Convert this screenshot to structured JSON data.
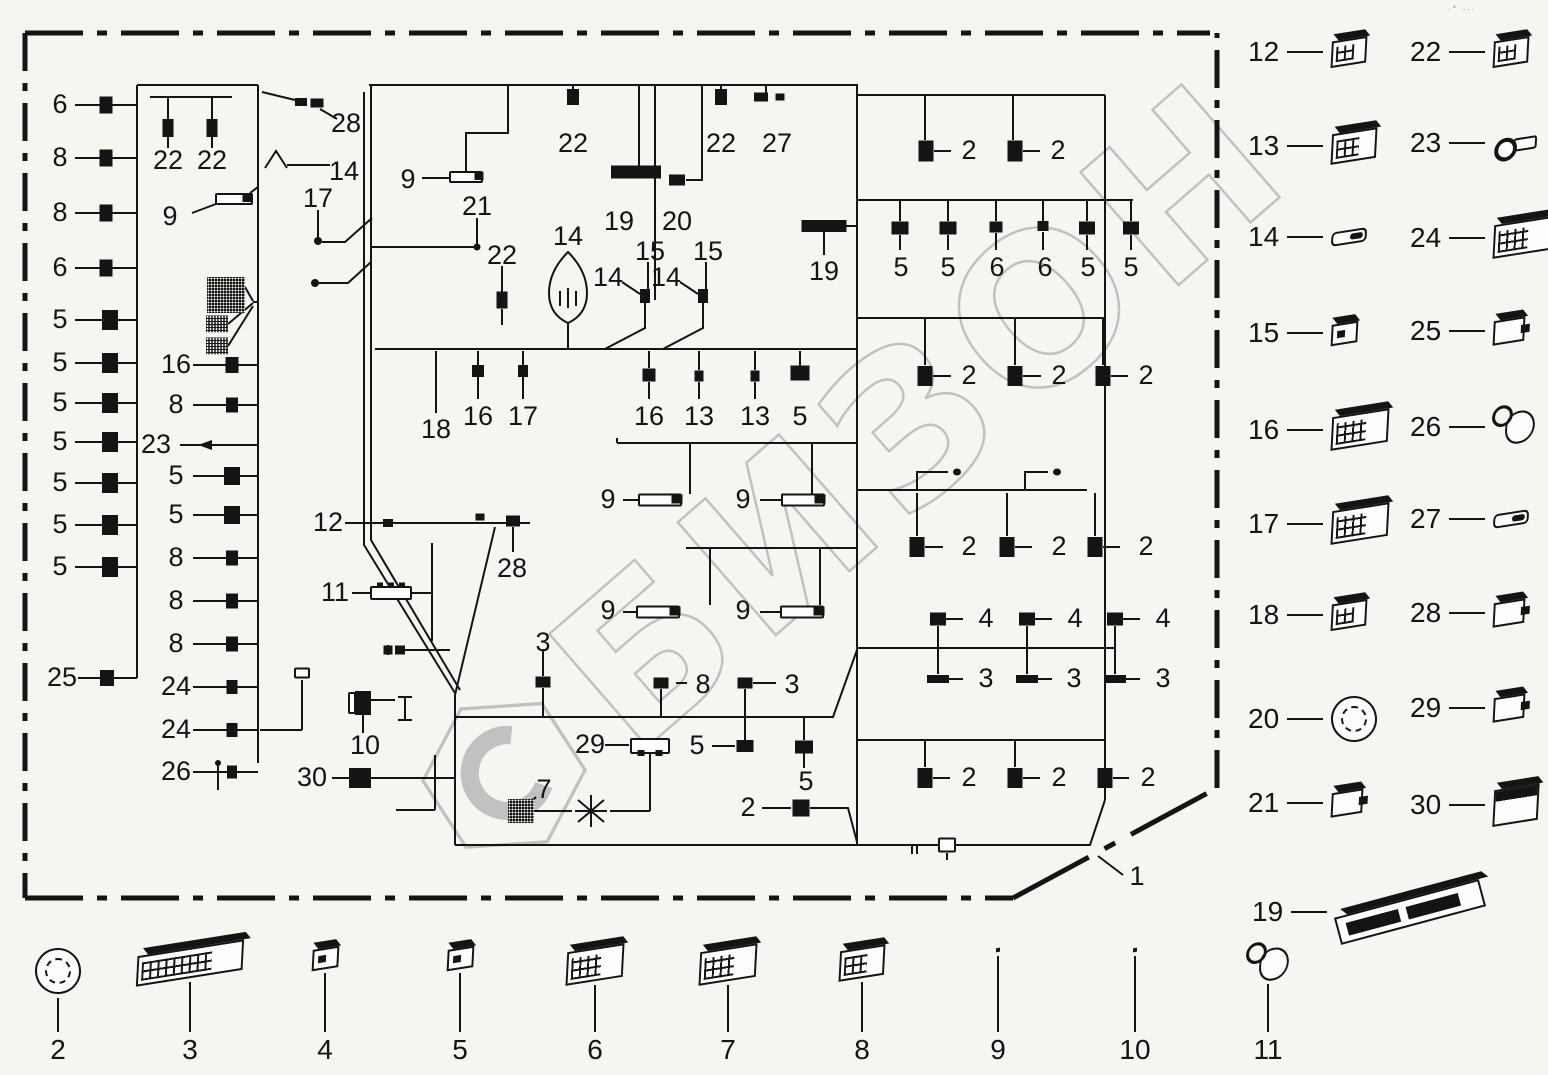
{
  "watermark": {
    "text": "БИЗОН",
    "color": "#c1c1c1"
  },
  "corner_marks": "∙°  ∙∙∙",
  "border": {
    "part_label": "1"
  },
  "diagram": {
    "callouts": [
      {
        "n": "6",
        "x": 60,
        "y": 105
      },
      {
        "n": "8",
        "x": 60,
        "y": 158
      },
      {
        "n": "8",
        "x": 60,
        "y": 213
      },
      {
        "n": "6",
        "x": 60,
        "y": 268
      },
      {
        "n": "5",
        "x": 60,
        "y": 320
      },
      {
        "n": "5",
        "x": 60,
        "y": 363
      },
      {
        "n": "5",
        "x": 60,
        "y": 403
      },
      {
        "n": "5",
        "x": 60,
        "y": 442
      },
      {
        "n": "5",
        "x": 60,
        "y": 483
      },
      {
        "n": "5",
        "x": 60,
        "y": 525
      },
      {
        "n": "5",
        "x": 60,
        "y": 567
      },
      {
        "n": "25",
        "x": 62,
        "y": 678
      },
      {
        "n": "22",
        "x": 168,
        "y": 161
      },
      {
        "n": "22",
        "x": 212,
        "y": 161
      },
      {
        "n": "9",
        "x": 170,
        "y": 217
      },
      {
        "n": "16",
        "x": 176,
        "y": 365
      },
      {
        "n": "8",
        "x": 176,
        "y": 405
      },
      {
        "n": "23",
        "x": 156,
        "y": 445
      },
      {
        "n": "5",
        "x": 176,
        "y": 476
      },
      {
        "n": "5",
        "x": 176,
        "y": 515
      },
      {
        "n": "8",
        "x": 176,
        "y": 558
      },
      {
        "n": "8",
        "x": 176,
        "y": 601
      },
      {
        "n": "8",
        "x": 176,
        "y": 644
      },
      {
        "n": "24",
        "x": 176,
        "y": 687
      },
      {
        "n": "24",
        "x": 176,
        "y": 730
      },
      {
        "n": "26",
        "x": 176,
        "y": 772
      },
      {
        "n": "28",
        "x": 346,
        "y": 124
      },
      {
        "n": "14",
        "x": 344,
        "y": 172
      },
      {
        "n": "17",
        "x": 318,
        "y": 199
      },
      {
        "n": "9",
        "x": 408,
        "y": 180
      },
      {
        "n": "21",
        "x": 477,
        "y": 207
      },
      {
        "n": "22",
        "x": 502,
        "y": 256
      },
      {
        "n": "22",
        "x": 573,
        "y": 144
      },
      {
        "n": "19",
        "x": 619,
        "y": 222
      },
      {
        "n": "20",
        "x": 677,
        "y": 222
      },
      {
        "n": "22",
        "x": 721,
        "y": 144
      },
      {
        "n": "27",
        "x": 777,
        "y": 144
      },
      {
        "n": "14",
        "x": 568,
        "y": 237
      },
      {
        "n": "15",
        "x": 650,
        "y": 252
      },
      {
        "n": "15",
        "x": 708,
        "y": 252
      },
      {
        "n": "14",
        "x": 608,
        "y": 278
      },
      {
        "n": "14",
        "x": 666,
        "y": 278
      },
      {
        "n": "19",
        "x": 824,
        "y": 272
      },
      {
        "n": "18",
        "x": 436,
        "y": 430
      },
      {
        "n": "16",
        "x": 478,
        "y": 417
      },
      {
        "n": "17",
        "x": 523,
        "y": 417
      },
      {
        "n": "16",
        "x": 649,
        "y": 417
      },
      {
        "n": "13",
        "x": 699,
        "y": 417
      },
      {
        "n": "13",
        "x": 755,
        "y": 417
      },
      {
        "n": "5",
        "x": 800,
        "y": 417
      },
      {
        "n": "12",
        "x": 328,
        "y": 523
      },
      {
        "n": "28",
        "x": 512,
        "y": 569
      },
      {
        "n": "11",
        "x": 335,
        "y": 593
      },
      {
        "n": "9",
        "x": 608,
        "y": 500
      },
      {
        "n": "9",
        "x": 743,
        "y": 500
      },
      {
        "n": "9",
        "x": 608,
        "y": 611
      },
      {
        "n": "9",
        "x": 743,
        "y": 611
      },
      {
        "n": "10",
        "x": 365,
        "y": 746
      },
      {
        "n": "30",
        "x": 312,
        "y": 778
      },
      {
        "n": "3",
        "x": 543,
        "y": 643
      },
      {
        "n": "8",
        "x": 703,
        "y": 685
      },
      {
        "n": "3",
        "x": 792,
        "y": 685
      },
      {
        "n": "29",
        "x": 590,
        "y": 745
      },
      {
        "n": "5",
        "x": 697,
        "y": 746
      },
      {
        "n": "5",
        "x": 806,
        "y": 782
      },
      {
        "n": "7",
        "x": 544,
        "y": 790
      },
      {
        "n": "2",
        "x": 748,
        "y": 808
      },
      {
        "n": "2",
        "x": 969,
        "y": 151
      },
      {
        "n": "2",
        "x": 1058,
        "y": 151
      },
      {
        "n": "5",
        "x": 901,
        "y": 268
      },
      {
        "n": "5",
        "x": 948,
        "y": 268
      },
      {
        "n": "6",
        "x": 997,
        "y": 268
      },
      {
        "n": "6",
        "x": 1045,
        "y": 268
      },
      {
        "n": "5",
        "x": 1088,
        "y": 268
      },
      {
        "n": "5",
        "x": 1131,
        "y": 268
      },
      {
        "n": "2",
        "x": 969,
        "y": 376
      },
      {
        "n": "2",
        "x": 1059,
        "y": 376
      },
      {
        "n": "2",
        "x": 1146,
        "y": 376
      },
      {
        "n": "2",
        "x": 969,
        "y": 547
      },
      {
        "n": "2",
        "x": 1059,
        "y": 547
      },
      {
        "n": "2",
        "x": 1146,
        "y": 547
      },
      {
        "n": "4",
        "x": 986,
        "y": 619
      },
      {
        "n": "4",
        "x": 1075,
        "y": 619
      },
      {
        "n": "4",
        "x": 1163,
        "y": 619
      },
      {
        "n": "3",
        "x": 986,
        "y": 679
      },
      {
        "n": "3",
        "x": 1074,
        "y": 679
      },
      {
        "n": "3",
        "x": 1163,
        "y": 679
      },
      {
        "n": "2",
        "x": 969,
        "y": 778
      },
      {
        "n": "2",
        "x": 1059,
        "y": 778
      },
      {
        "n": "2",
        "x": 1148,
        "y": 778
      },
      {
        "n": "1",
        "x": 1137,
        "y": 877
      }
    ],
    "glyphs": [
      [
        106,
        105,
        13,
        17
      ],
      [
        106,
        158,
        13,
        17
      ],
      [
        106,
        213,
        13,
        17
      ],
      [
        106,
        268,
        13,
        17
      ],
      [
        110,
        320,
        16,
        20
      ],
      [
        110,
        363,
        16,
        20
      ],
      [
        110,
        403,
        16,
        20
      ],
      [
        110,
        442,
        16,
        20
      ],
      [
        110,
        483,
        16,
        20
      ],
      [
        110,
        525,
        16,
        20
      ],
      [
        110,
        567,
        16,
        20
      ],
      [
        107,
        678,
        14,
        16
      ],
      [
        168,
        128,
        11,
        18
      ],
      [
        212,
        128,
        11,
        18
      ],
      [
        232,
        365,
        13,
        16
      ],
      [
        232,
        405,
        12,
        15
      ],
      [
        232,
        476,
        16,
        18
      ],
      [
        232,
        515,
        16,
        18
      ],
      [
        232,
        558,
        12,
        15
      ],
      [
        232,
        601,
        12,
        15
      ],
      [
        232,
        644,
        12,
        15
      ],
      [
        232,
        687,
        11,
        14
      ],
      [
        232,
        730,
        11,
        14
      ],
      [
        232,
        772,
        10,
        13
      ],
      [
        226,
        295,
        38,
        36,
        "d"
      ],
      [
        217,
        324,
        22,
        17,
        "d"
      ],
      [
        217,
        346,
        22,
        17,
        "d"
      ],
      [
        301,
        102,
        12,
        8
      ],
      [
        317,
        103,
        13,
        9
      ],
      [
        234,
        199,
        38,
        12,
        "o"
      ],
      [
        247,
        198,
        9,
        8
      ],
      [
        302,
        673,
        16,
        11,
        "o"
      ],
      [
        218,
        763,
        6,
        6,
        "r"
      ],
      [
        573,
        97,
        12,
        16
      ],
      [
        721,
        97,
        12,
        16
      ],
      [
        761,
        97,
        14,
        9
      ],
      [
        780,
        97,
        9,
        7
      ],
      [
        636,
        172,
        50,
        13
      ],
      [
        677,
        180,
        16,
        11
      ],
      [
        466,
        177,
        34,
        12,
        "o"
      ],
      [
        479,
        176,
        9,
        8
      ],
      [
        477,
        247,
        7,
        7,
        "r"
      ],
      [
        318,
        241,
        8,
        8,
        "r"
      ],
      [
        315,
        283,
        8,
        8,
        "r"
      ],
      [
        502,
        300,
        11,
        17
      ],
      [
        645,
        296,
        10,
        14
      ],
      [
        703,
        296,
        10,
        14
      ],
      [
        478,
        371,
        12,
        12
      ],
      [
        523,
        371,
        10,
        12
      ],
      [
        649,
        375,
        13,
        13
      ],
      [
        699,
        376,
        9,
        11
      ],
      [
        755,
        376,
        9,
        11
      ],
      [
        800,
        373,
        19,
        15
      ],
      [
        388,
        523,
        10,
        8
      ],
      [
        480,
        517,
        9,
        7
      ],
      [
        513,
        521,
        14,
        11
      ],
      [
        391,
        593,
        42,
        14,
        "o"
      ],
      [
        380,
        585,
        6,
        5
      ],
      [
        391,
        585,
        6,
        5
      ],
      [
        402,
        585,
        6,
        5
      ],
      [
        660,
        500,
        44,
        13,
        "o"
      ],
      [
        677,
        499,
        11,
        9
      ],
      [
        803,
        500,
        44,
        13,
        "o"
      ],
      [
        820,
        499,
        11,
        9
      ],
      [
        658,
        612,
        44,
        13,
        "o"
      ],
      [
        675,
        611,
        11,
        9
      ],
      [
        802,
        612,
        44,
        13,
        "o"
      ],
      [
        819,
        611,
        11,
        9
      ],
      [
        363,
        703,
        16,
        24
      ],
      [
        352,
        703,
        8,
        22,
        "o"
      ],
      [
        388,
        650,
        9,
        9
      ],
      [
        400,
        650,
        10,
        9
      ],
      [
        360,
        778,
        22,
        20
      ],
      [
        521,
        811,
        26,
        24,
        "d"
      ],
      [
        543,
        682,
        15,
        11
      ],
      [
        661,
        683,
        15,
        11
      ],
      [
        745,
        683,
        15,
        11
      ],
      [
        745,
        746,
        17,
        12
      ],
      [
        804,
        747,
        18,
        13
      ],
      [
        650,
        746,
        40,
        16,
        "o"
      ],
      [
        641,
        753,
        7,
        6
      ],
      [
        659,
        753,
        7,
        6
      ],
      [
        801,
        808,
        17,
        17
      ],
      [
        926,
        151,
        15,
        21
      ],
      [
        1015,
        151,
        15,
        21
      ],
      [
        900,
        228,
        17,
        13
      ],
      [
        948,
        228,
        17,
        13
      ],
      [
        996,
        227,
        13,
        11
      ],
      [
        1043,
        226,
        11,
        10
      ],
      [
        1087,
        228,
        16,
        13
      ],
      [
        1131,
        228,
        16,
        13
      ],
      [
        824,
        226,
        45,
        12
      ],
      [
        925,
        376,
        15,
        20
      ],
      [
        1015,
        376,
        15,
        20
      ],
      [
        1103,
        376,
        15,
        20
      ],
      [
        957,
        472,
        8,
        7,
        "r"
      ],
      [
        1057,
        472,
        8,
        7,
        "r"
      ],
      [
        917,
        547,
        15,
        20
      ],
      [
        1007,
        547,
        15,
        20
      ],
      [
        1095,
        547,
        15,
        20
      ],
      [
        938,
        619,
        16,
        13
      ],
      [
        1027,
        619,
        16,
        13
      ],
      [
        1115,
        619,
        16,
        13
      ],
      [
        938,
        679,
        22,
        8
      ],
      [
        1027,
        679,
        22,
        8
      ],
      [
        1115,
        679,
        22,
        8
      ],
      [
        925,
        778,
        15,
        20
      ],
      [
        1015,
        778,
        15,
        20
      ],
      [
        1105,
        778,
        15,
        20
      ],
      [
        947,
        845,
        18,
        15,
        "o"
      ]
    ]
  },
  "legend": {
    "right": [
      {
        "n": "12",
        "x": 1248,
        "y": 55,
        "ic": "conn-sm"
      },
      {
        "n": "22",
        "x": 1410,
        "y": 55,
        "ic": "conn-sm"
      },
      {
        "n": "13",
        "x": 1248,
        "y": 148,
        "ic": "conn"
      },
      {
        "n": "23",
        "x": 1410,
        "y": 146,
        "ic": "ring"
      },
      {
        "n": "14",
        "x": 1248,
        "y": 240,
        "ic": "sleeve"
      },
      {
        "n": "24",
        "x": 1410,
        "y": 238,
        "ic": "conn-lg"
      },
      {
        "n": "15",
        "x": 1248,
        "y": 336,
        "ic": "plug"
      },
      {
        "n": "25",
        "x": 1410,
        "y": 334,
        "ic": "clip"
      },
      {
        "n": "16",
        "x": 1248,
        "y": 430,
        "ic": "conn-lg"
      },
      {
        "n": "26",
        "x": 1410,
        "y": 428,
        "ic": "cap"
      },
      {
        "n": "17",
        "x": 1248,
        "y": 524,
        "ic": "conn-lg"
      },
      {
        "n": "27",
        "x": 1410,
        "y": 522,
        "ic": "sleeve"
      },
      {
        "n": "18",
        "x": 1248,
        "y": 618,
        "ic": "conn-sm"
      },
      {
        "n": "28",
        "x": 1410,
        "y": 616,
        "ic": "clip"
      },
      {
        "n": "20",
        "x": 1248,
        "y": 713,
        "ic": "round-lg"
      },
      {
        "n": "29",
        "x": 1410,
        "y": 711,
        "ic": "clip"
      },
      {
        "n": "21",
        "x": 1248,
        "y": 806,
        "ic": "clip"
      },
      {
        "n": "30",
        "x": 1410,
        "y": 804,
        "ic": "block"
      },
      {
        "n": "19",
        "x": 1252,
        "y": 915,
        "ic": "ecu"
      }
    ],
    "bottom": [
      {
        "n": "2",
        "x": 58,
        "ic": "round-lg"
      },
      {
        "n": "3",
        "x": 190,
        "ic": "ecu-mid"
      },
      {
        "n": "4",
        "x": 325,
        "ic": "plug"
      },
      {
        "n": "5",
        "x": 460,
        "ic": "plug"
      },
      {
        "n": "6",
        "x": 595,
        "ic": "conn-lg"
      },
      {
        "n": "7",
        "x": 728,
        "ic": "conn-lg"
      },
      {
        "n": "8",
        "x": 862,
        "ic": "conn"
      },
      {
        "n": "9",
        "x": 998,
        "ic": "frame"
      },
      {
        "n": "10",
        "x": 1135,
        "ic": "frame"
      },
      {
        "n": "11",
        "x": 1268,
        "ic": "cap"
      }
    ]
  }
}
